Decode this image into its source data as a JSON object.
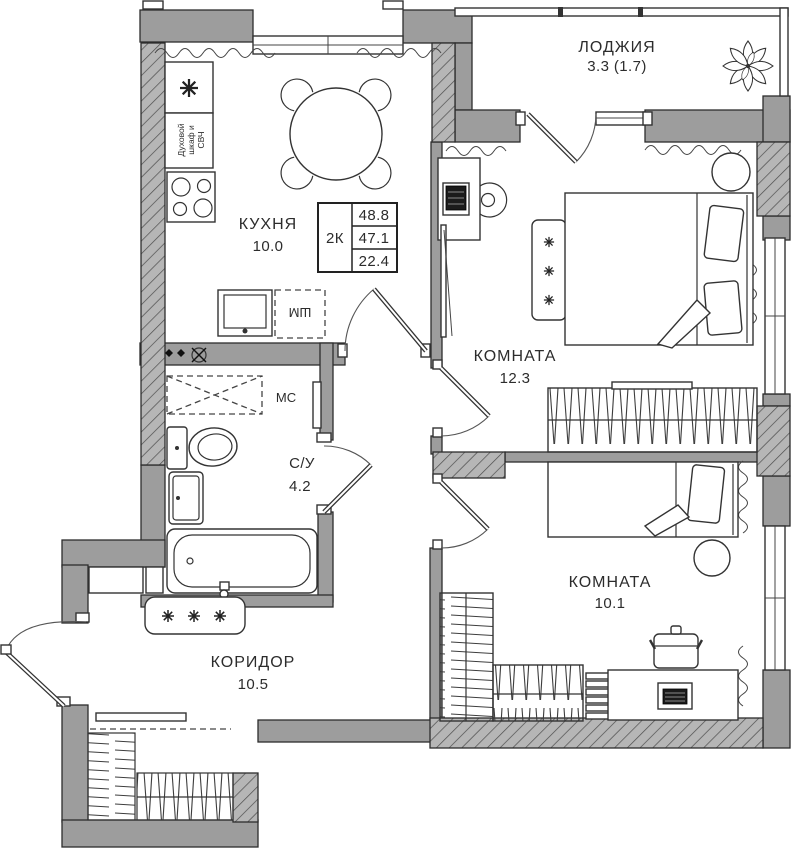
{
  "plan_title": "2-room apartment floor plan",
  "colors": {
    "wall": "#9d9d9d",
    "wall_stroke": "#2d2d2d",
    "line": "#333333",
    "background": "#ffffff"
  },
  "rooms": {
    "loggia": {
      "name": "ЛОДЖИЯ",
      "area": "3.3 (1.7)"
    },
    "kitchen": {
      "name": "КУХНЯ",
      "area": "10.0"
    },
    "room_large": {
      "name": "КОМНАТА",
      "area": "12.3"
    },
    "room_small": {
      "name": "КОМНАТА",
      "area": "10.1"
    },
    "bathroom": {
      "name": "С/У",
      "area": "4.2"
    },
    "hallway": {
      "name": "КОРИДОР",
      "area": "10.5"
    }
  },
  "info_table": {
    "type": "2К",
    "rows": [
      "48.8",
      "47.1",
      "22.4"
    ]
  },
  "appliances": {
    "oven_lines": [
      "Духовой",
      "шкаф и",
      "СВЧ"
    ],
    "washing_machine": "ШМ",
    "storage": "МС"
  }
}
